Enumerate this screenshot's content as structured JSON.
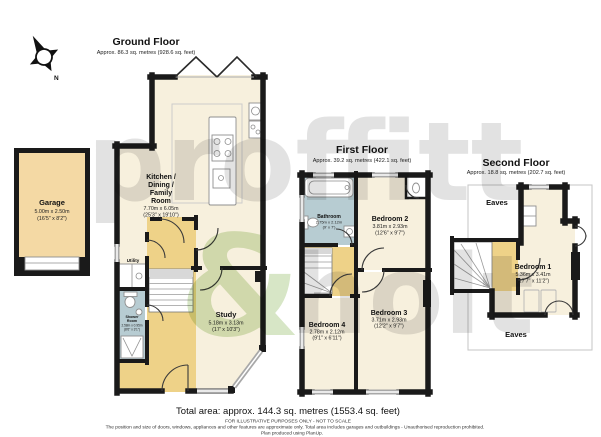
{
  "page": {
    "compass_label": "N",
    "watermark": {
      "word1": "proffitt",
      "ampersand": "&",
      "word2": "holt"
    }
  },
  "colors": {
    "room_fill": "#f7f0dd",
    "hall_fill": "#eed288",
    "wet_room_fill": "#b7ccd2",
    "garage_fill": "#f4d9a4",
    "wall": "#1a1a1a",
    "watermark_gray": "#e2e2e2",
    "watermark_green": "#d7e6c6"
  },
  "floors": {
    "ground": {
      "title": "Ground Floor",
      "area": "Approx. 86.3 sq. metres (928.6 sq. feet)"
    },
    "first": {
      "title": "First Floor",
      "area": "Approx. 39.2 sq. metres (422.1 sq. feet)"
    },
    "second": {
      "title": "Second Floor",
      "area": "Approx. 18.8 sq. metres (202.7 sq. feet)"
    }
  },
  "rooms": {
    "garage": {
      "name": "Garage",
      "dims_m": "5.00m x 2.50m",
      "dims_ft": "(16'5\" x 8'2\")"
    },
    "kitchen": {
      "name_lines": [
        "Kitchen /",
        "Dining /",
        "Family",
        "Room"
      ],
      "dims_m": "7.70m x 6.05m",
      "dims_ft": "(25'3\" x 19'10\")"
    },
    "utility": {
      "name": "Utility"
    },
    "shower_room": {
      "name_lines": [
        "Shower",
        "Room"
      ],
      "dims_m": "2.58m x 0.95m",
      "dims_ft": "(8'6\" x 3'1\")"
    },
    "study": {
      "name": "Study",
      "dims_m": "5.18m x 3.13m",
      "dims_ft": "(17' x 10'3\")"
    },
    "bathroom": {
      "name": "Bathroom",
      "dims_m": "2.75m x 2.12m",
      "dims_ft": "(9' x 7')"
    },
    "bedroom1": {
      "name": "Bedroom 1",
      "dims_m": "5.36m x 3.41m",
      "dims_ft": "(17'7\" x 11'2\")"
    },
    "bedroom2": {
      "name": "Bedroom 2",
      "dims_m": "3.81m x 2.93m",
      "dims_ft": "(12'6\" x 9'7\")"
    },
    "bedroom3": {
      "name": "Bedroom 3",
      "dims_m": "3.71m x 2.93m",
      "dims_ft": "(12'2\" x 9'7\")"
    },
    "bedroom4": {
      "name": "Bedroom 4",
      "dims_m": "2.78m x 2.12m",
      "dims_ft": "(9'1\" x 6'11\")"
    },
    "eaves_top": {
      "name": "Eaves"
    },
    "eaves_bottom": {
      "name": "Eaves"
    }
  },
  "footer": {
    "total_area": "Total area: approx. 144.3 sq. metres (1553.4 sq. feet)",
    "disclaimer1": "FOR ILLUSTRATIVE PURPOSES ONLY - NOT TO SCALE",
    "disclaimer2": "The position and size of doors, windows, appliances and other features are approximate only. Total area includes garages and outbuildings - Unauthorised reproduction prohibited.",
    "disclaimer3": "Plan produced using PlanUp."
  }
}
